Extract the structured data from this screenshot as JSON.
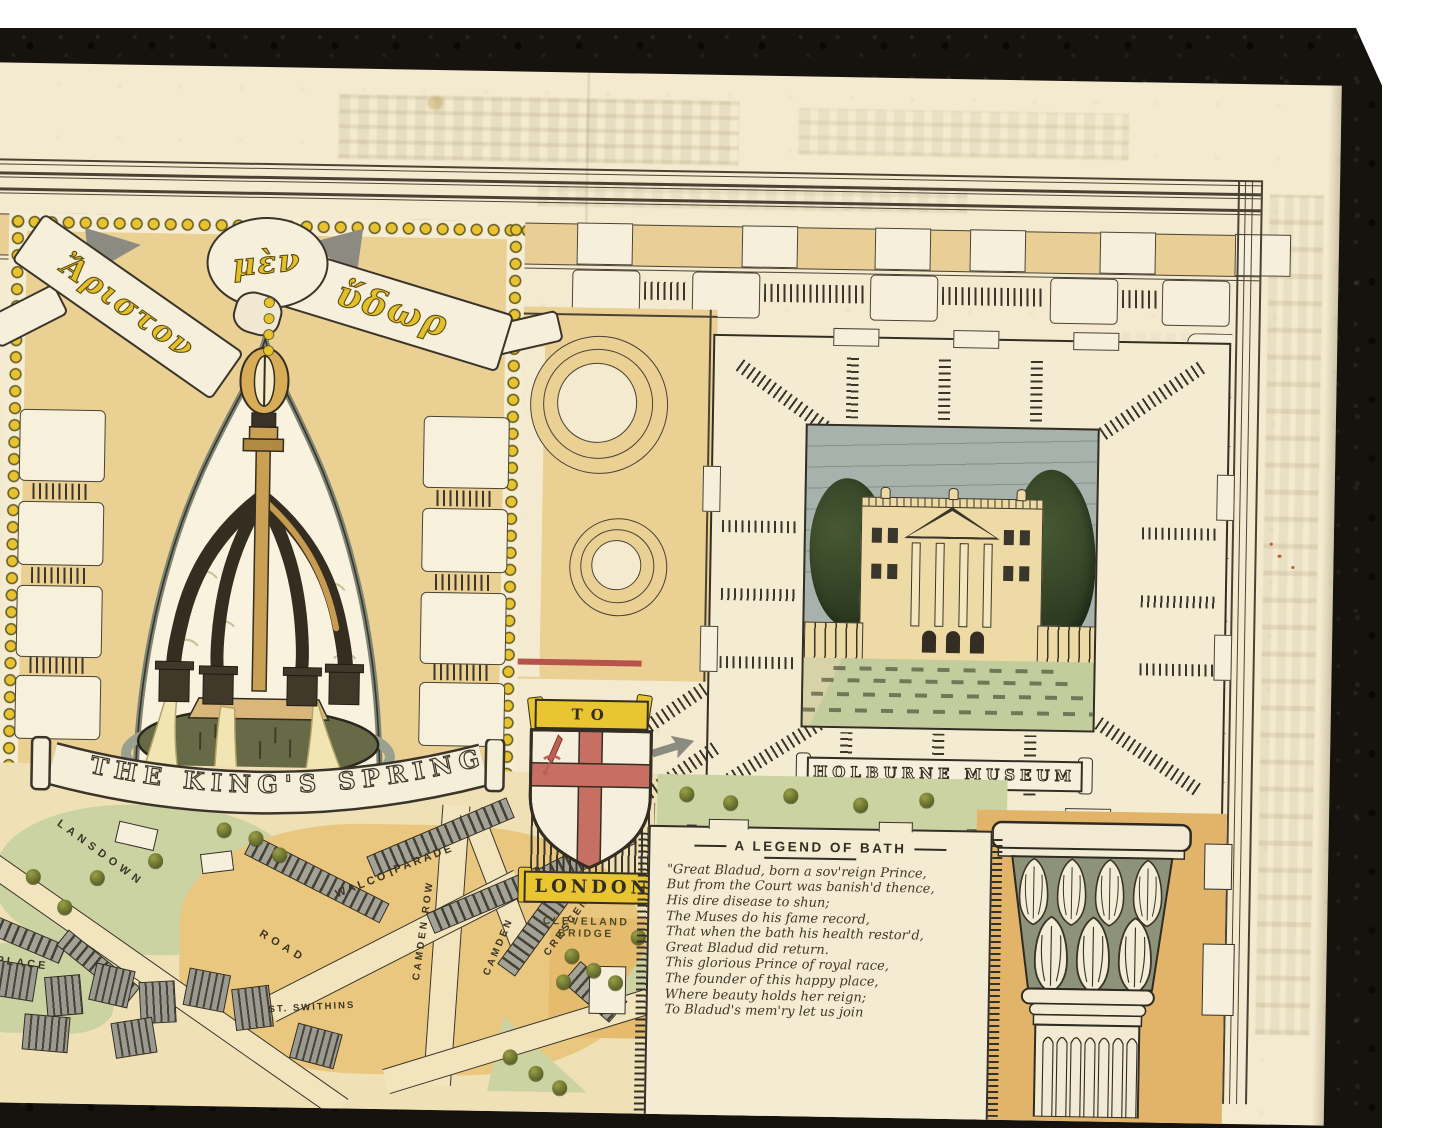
{
  "map": {
    "greek_banner": {
      "left": "Ἄριστον",
      "center": "μὲν",
      "right": "ὕδωρ"
    },
    "kings_spring_label": "THE KING'S SPRING",
    "museum_label": "HOLBURNE MUSEUM",
    "london_shield": {
      "to": "TO",
      "london": "LONDON"
    },
    "legend_poem": {
      "title": "A LEGEND OF BATH",
      "lines": [
        "\"Great Bladud, born a sov'reign Prince,",
        "But from the Court was banish'd thence,",
        "His dire disease to shun;",
        "The Muses do his fame record,",
        "That when the bath his health restor'd,",
        "Great Bladud did return.",
        "This glorious Prince of royal race,",
        "The founder of this happy place,",
        "Where beauty holds her reign;",
        "To Bladud's mem'ry let us join"
      ]
    },
    "streets": {
      "lansdown": "LANSDOWN",
      "road": "ROAD",
      "nd_place": "ND PLACE",
      "camden_row": "CAMDEN ROW",
      "camden": "CAMDEN",
      "crescent": "CRESCENT",
      "walcot": "WALCOT",
      "parade": "PARADE",
      "st_swithins": "ST. SWITHINS",
      "cleveland": "CLEVELAND",
      "bridge": "BRIDGE"
    },
    "colors": {
      "paper": "#f3ead0",
      "frame": "#16130e",
      "gold": "#e8c531",
      "red": "#c76f62",
      "park_green": "#ccd3a3",
      "tan": "#eac77f",
      "sky": "#a7b2ac",
      "ink": "#332d22"
    }
  }
}
